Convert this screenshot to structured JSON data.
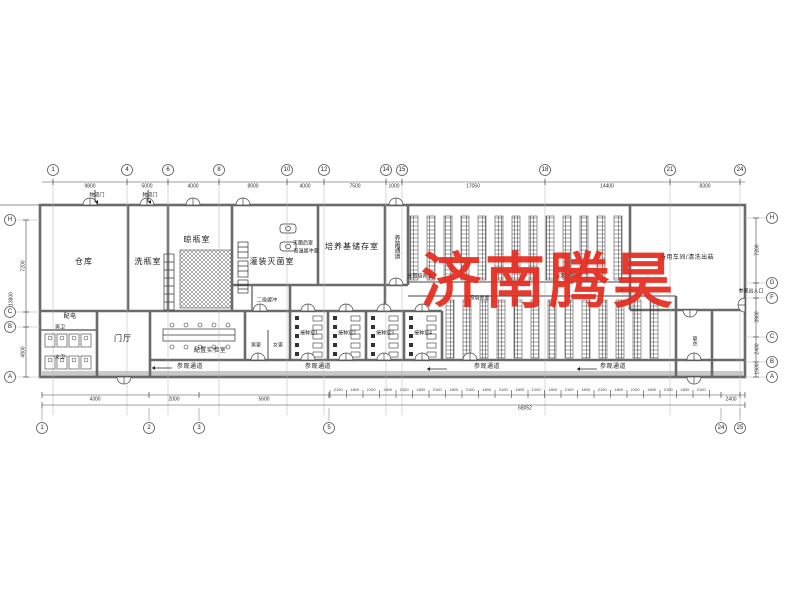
{
  "watermark": {
    "text": "济南腾昊",
    "color": "#e62b1e"
  },
  "rooms": {
    "warehouse": "仓库",
    "bottle_washing": "洗瓶室",
    "bottle_airing": "晾瓶室",
    "filling_sterilizing": "灌装灭菌室",
    "medium_storage": "培养基储存室",
    "culture_corridor": "养菌通道",
    "spare_workshop": "备用车间/清洗出菇",
    "power_room": "配电",
    "male_toilet": "男卫",
    "female_toilet": "女卫",
    "lobby": "门厅",
    "prep_lab": "配置实验室",
    "buffer2": "二级缓冲",
    "male_change": "男更",
    "female_change": "女更",
    "inoculation1": "接种室1",
    "inoculation2": "接种室2",
    "inoculation3": "接种室3",
    "inoculation4": "接种室4",
    "post_steril": "灭菌后室",
    "high_temp_buffer": "高温缓冲室",
    "light_culture": "光照培养室",
    "change_room": "更衣",
    "visitor_entrance": "参观出入口",
    "logistics_door": "物流门",
    "visitor_corridor": "参观通道"
  },
  "axes": {
    "top": [
      "1",
      "4",
      "6",
      "8",
      "10",
      "12",
      "14",
      "15",
      "18",
      "21",
      "24"
    ],
    "bottom": [
      "1",
      "2",
      "3",
      "5",
      "24",
      "25"
    ],
    "left": [
      "H",
      "C",
      "B",
      "A"
    ],
    "right": [
      "H",
      "G",
      "F",
      "C",
      "B",
      "A"
    ]
  },
  "dims": {
    "top": [
      "9800",
      "5000",
      "4000",
      "8000",
      "4000",
      "7500",
      "1000",
      "17050",
      "14400",
      "8300"
    ],
    "bottom": [
      "4300",
      "2000",
      "5600",
      "2400"
    ],
    "bottom_total": "68052",
    "bottom_run": [
      "2100",
      "1800"
    ],
    "left": [
      "7200",
      "4800",
      "13800"
    ],
    "right": [
      "7200",
      "3900",
      "2400",
      "1500"
    ]
  }
}
